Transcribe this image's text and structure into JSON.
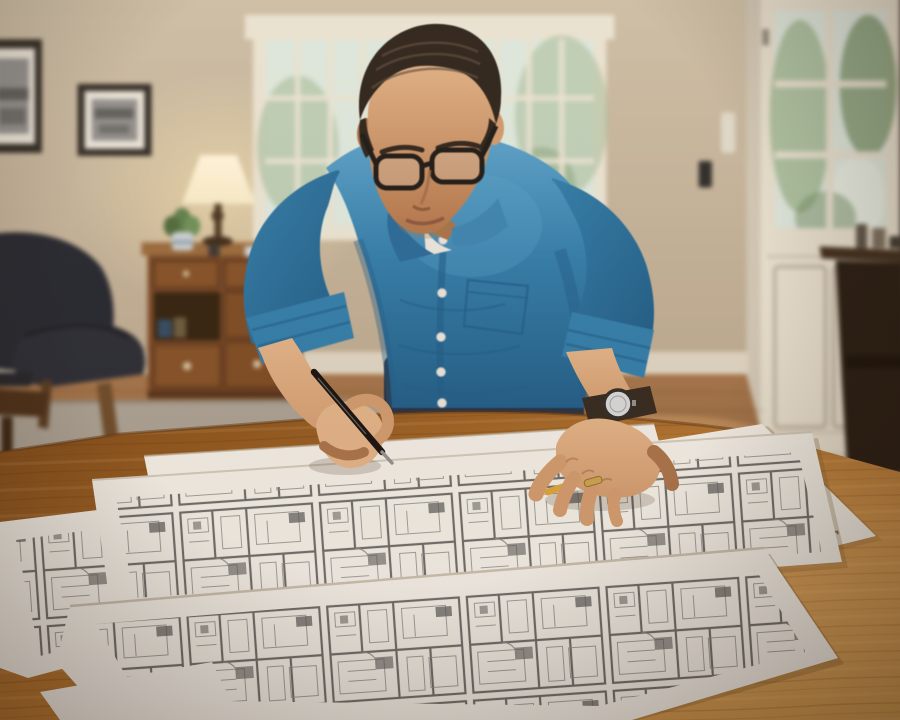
{
  "scene": {
    "medium": "photograph",
    "setting": "home living room interior, eye level, shallow depth of field",
    "subject": "man in blue button-up shirt leaning over a wooden table, annotating architectural floor-plan blueprints with a pen"
  },
  "objects": {
    "person": {
      "pose": "bent forward over table, head down",
      "shirt_buttons_visible": 6,
      "accessories": [
        "black-framed eyeglasses",
        "wristwatch with dark leather band",
        "gold ring"
      ],
      "held_tool": "black mechanical pen",
      "clothing": [
        "blue chambray button-up shirt, sleeves rolled",
        "dark navy trousers",
        "white undershirt at collar"
      ]
    },
    "blueprints": {
      "sheet_count": 5,
      "content": "gray-line architectural floor plans and building elevations",
      "extra_item": "yellow pencil under right hand"
    },
    "room": [
      "sash window behind subject",
      "glass-paned front door with greenery outside",
      "two framed black-and-white photos",
      "lit table lamp with cream shade",
      "potted green plant",
      "wooden writing desk with drawers",
      "dark navy armchair with wooden legs",
      "gray area rug",
      "hardwood floor",
      "dark side table",
      "dark treadle table by door",
      "light switch",
      "white wall device"
    ]
  },
  "palette": {
    "wall": "#cdbfa8",
    "wallDark": "#8f8270",
    "baseboard": "#ddd5c3",
    "windowTrim": "#e9e4d4",
    "glass": "#dde8e0",
    "foliage": "#9db894",
    "foliageDark": "#6e8f63",
    "doorWhite": "#e7e1d1",
    "doorShadow": "#b6ad9b",
    "trimShadow": "#cfc8b6",
    "frame": "#2e2b27",
    "mat": "#e8e4da",
    "photo": "#8f8f8f",
    "floor": "#a4744a",
    "floorDark": "#7a4e2b",
    "rug": "#a8a093",
    "chair": "#222631",
    "chairDark": "#15181f",
    "wood": "#7b4a26",
    "woodDark": "#54311a",
    "woodLight": "#9a6a3c",
    "lampShade": "#f8ecc9",
    "lampGlow": "#ffe9b2",
    "lampBase": "#4a3420",
    "plant": "#5d7f4b",
    "pot": "#c9d2d8",
    "hair": "#2b231d",
    "hairSheen": "#5d4c3e",
    "skin": "#cf9a6f",
    "skinLight": "#e0b289",
    "skinShadow": "#a7714a",
    "shirt": "#2f7dac",
    "shirtDark": "#1d5c89",
    "shirtLight": "#5aa2cd",
    "undershirt": "#e9e6df",
    "pants": "#253044",
    "glasses": "#1c1917",
    "pen": "#141110",
    "pencil": "#d9a43b",
    "watchBand": "#32281f",
    "watchFace": "#d6d8da",
    "ring": "#c9a050",
    "table": "#b3742f",
    "tableLight": "#d29b4f",
    "tableDark": "#7c4817",
    "paper": "#efede7",
    "paperShadow": "#b9ab94",
    "ink": "#8a8a8a",
    "inkDark": "#565656",
    "darkFurniture": "#241a12"
  }
}
